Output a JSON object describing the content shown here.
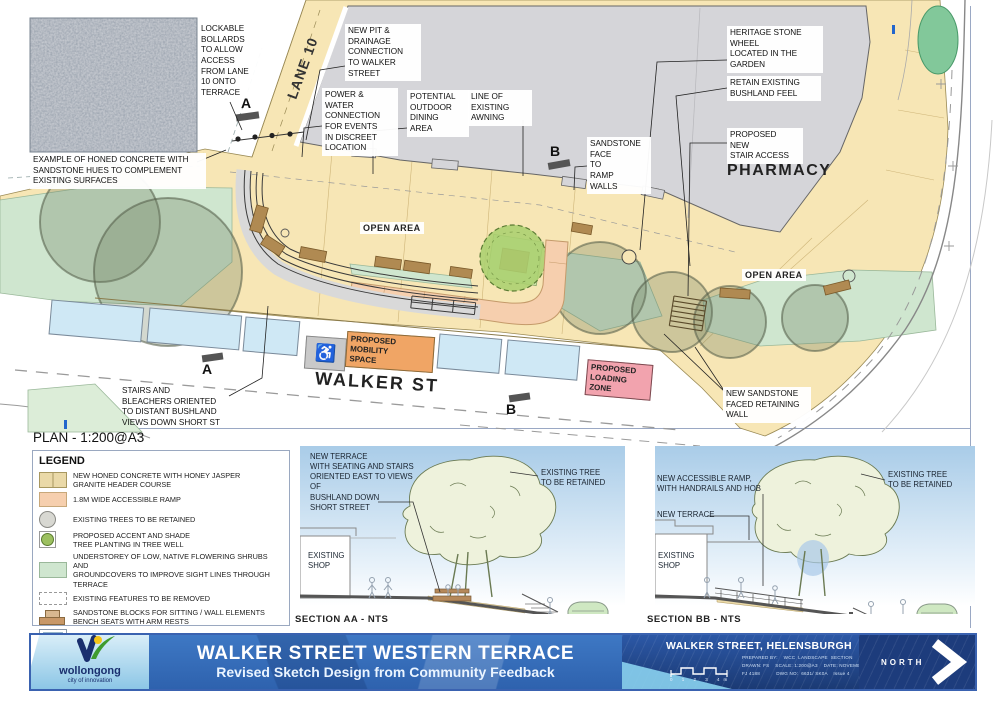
{
  "colors": {
    "terrace_paving": "#f7e6b5",
    "building": "#d5d5d9",
    "understorey_green": "#cfe6cf",
    "accessible_ramp": "#f6cfae",
    "parking_blue": "#cfe8f5",
    "mobility_orange": "#f0a565",
    "loading_pink": "#f2a3ae",
    "accent_tree_green": "#abd06f",
    "titlebar_blue": "#2e62ae",
    "titlebar_dark_blue": "#1d3c7c",
    "titlebar_light_blue": "#8cc6e6"
  },
  "plan": {
    "scale_title": "PLAN - 1:200@A3",
    "texture_caption": "EXAMPLE OF HONED CONCRETE WITH\nSANDSTONE HUES TO COMPLEMENT\nEXISTING SURFACES",
    "lane_label": "LANE 10",
    "walker_label": "WALKER ST",
    "pharmacy_label": "PHARMACY",
    "open_area_1": "OPEN AREA",
    "open_area_2": "OPEN AREA",
    "marker_a": "A",
    "marker_b": "B",
    "mobility_zone": "PROPOSED\nMOBILITY\nSPACE",
    "mobility_icon": "♿",
    "loading_zone": "PROPOSED\nLOADING\nZONE",
    "callouts": [
      {
        "id": "lockable-bollards",
        "text": "LOCKABLE\nBOLLARDS\nTO ALLOW\nACCESS\nFROM LANE\n10 ONTO\nTERRACE"
      },
      {
        "id": "new-pit",
        "text": "NEW PIT &\nDRAINAGE\nCONNECTION\nTO WALKER\nSTREET"
      },
      {
        "id": "power-water",
        "text": "POWER &\nWATER\nCONNECTION\nFOR EVENTS\nIN DISCREET\nLOCATION"
      },
      {
        "id": "outdoor-dining",
        "text": "POTENTIAL\nOUTDOOR\nDINING\nAREA"
      },
      {
        "id": "awning",
        "text": "LINE OF\nEXISTING\nAWNING"
      },
      {
        "id": "sandstone-face",
        "text": "SANDSTONE\nFACE\nTO\nRAMP\nWALLS"
      },
      {
        "id": "heritage-wheel",
        "text": "HERITAGE STONE\nWHEEL\nLOCATED IN THE\nGARDEN"
      },
      {
        "id": "retain-bushland",
        "text": "RETAIN EXISTING\nBUSHLAND FEEL"
      },
      {
        "id": "stair-access",
        "text": "PROPOSED\nNEW\nSTAIR ACCESS"
      },
      {
        "id": "retaining-wall",
        "text": "NEW SANDSTONE\nFACED RETAINING\nWALL"
      },
      {
        "id": "stairs-bleachers",
        "text": "STAIRS AND\nBLEACHERS ORIENTED\nTO DISTANT BUSHLAND\nVIEWS DOWN SHORT ST"
      }
    ]
  },
  "legend": {
    "title": "LEGEND",
    "items": [
      {
        "swatch": "concrete",
        "label": "NEW HONED CONCRETE WITH HONEY JASPER\nGRANITE HEADER COURSE"
      },
      {
        "swatch": "ramp",
        "label": "1.8M WIDE ACCESSIBLE RAMP"
      },
      {
        "swatch": "tree-retained",
        "label": "EXISTING TREES TO BE RETAINED"
      },
      {
        "swatch": "tree-proposed",
        "label": "PROPOSED ACCENT AND SHADE\nTREE PLANTING IN TREE WELL"
      },
      {
        "swatch": "understorey",
        "label": "UNDERSTOREY OF LOW, NATIVE FLOWERING SHRUBS AND\nGROUNDCOVERS TO IMPROVE SIGHT LINES THROUGH TERRACE"
      },
      {
        "swatch": "removed",
        "label": "EXISTING FEATURES TO BE REMOVED"
      },
      {
        "swatch": "sandstone",
        "label": "SANDSTONE BLOCKS FOR SITTING / WALL ELEMENTS\nBENCH SEATS WITH ARM RESTS"
      },
      {
        "swatch": "parking",
        "label": "EXISTING 1 HOUR PARKING"
      }
    ]
  },
  "sections": {
    "aa": {
      "note_terrace": "NEW TERRACE\nWITH SEATING AND STAIRS\nORIENTED EAST TO VIEWS OF\nBUSHLAND DOWN\nSHORT STREET",
      "note_tree": "EXISTING TREE\nTO BE RETAINED",
      "note_shop": "EXISTING\nSHOP",
      "caption": "SECTION AA - NTS"
    },
    "bb": {
      "note_ramp": "NEW ACCESSIBLE RAMP,\nWITH HANDRAILS AND HOB",
      "note_terrace": "NEW TERRACE",
      "note_shop": "EXISTING\nSHOP",
      "note_tree": "EXISTING TREE\nTO BE RETAINED",
      "caption": "SECTION BB - NTS"
    }
  },
  "titlebar": {
    "logo_name": "wollongong",
    "logo_tagline": "city of innovation",
    "title": "WALKER STREET WESTERN TERRACE",
    "subtitle": "Revised Sketch Design from Community Feedback",
    "location": "WALKER STREET, HELENSBURGH",
    "meta_line1": "PREPARED BY:    WCC  LANDSCAPE  SECTION",
    "meta_line2": "DRAWN: FS    SCALE: 1:200@A3    DATE: NOVEMBER 2021",
    "meta_line3": "FJ 4188           DWG NO:  6631/ SK0A    Issue 4",
    "north_label": "NORTH",
    "scale_ticks": "0 1 2 3 4m"
  }
}
